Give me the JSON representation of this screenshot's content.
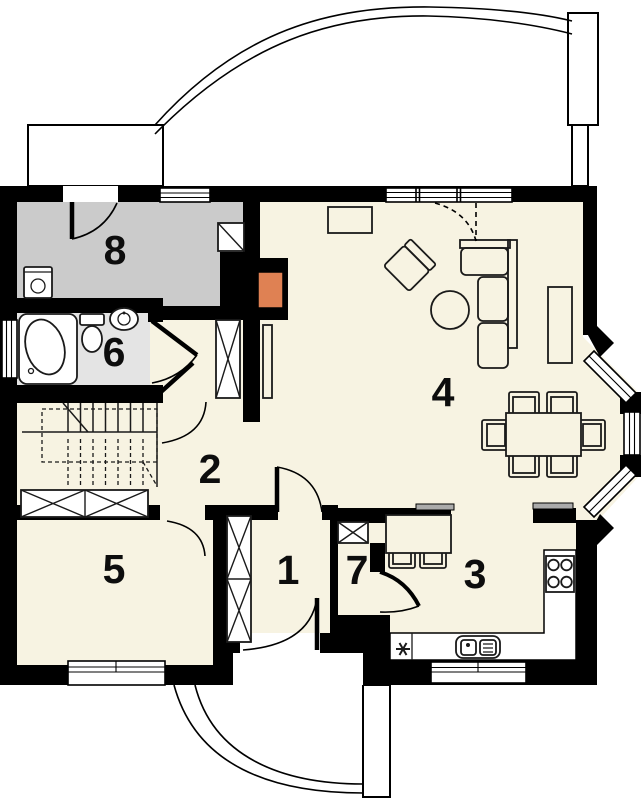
{
  "canvas": {
    "width": 642,
    "height": 800,
    "background": "#FFFFFF"
  },
  "colors": {
    "wall": "#000000",
    "floor": "#F7F3E2",
    "room8_floor": "#CBCBCB",
    "bathroom_floor": "#E4E4E4",
    "fireplace_accent": "#DF8153",
    "counter_shelf_gray": "#ABABAB",
    "line": "#1A1A1A",
    "white": "#FFFFFF"
  },
  "rooms": [
    {
      "label": "1"
    },
    {
      "label": "2"
    },
    {
      "label": "3"
    },
    {
      "label": "4"
    },
    {
      "label": "5"
    },
    {
      "label": "6"
    },
    {
      "label": "7"
    },
    {
      "label": "8"
    }
  ],
  "icons": {
    "kitchen_utility_marker": "✳"
  }
}
